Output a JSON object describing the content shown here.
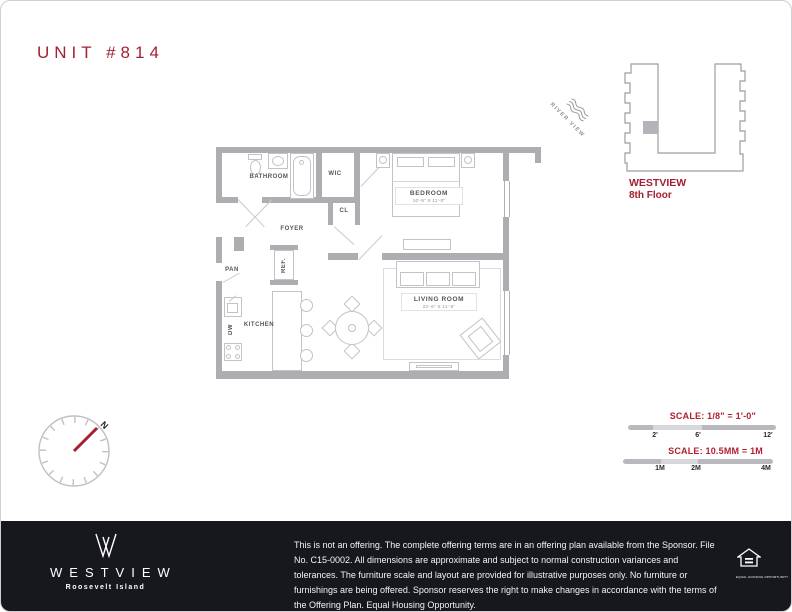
{
  "page": {
    "title": "UNIT #814"
  },
  "plan": {
    "labels": {
      "bathroom": "BATHROOM",
      "wic": "WIC",
      "closet": "CL",
      "foyer": "FOYER",
      "bedroom": "BEDROOM",
      "bedroom_dims": "10'-9\" X 11'-0\"",
      "pantry": "PAN",
      "refrigerator": "REF.",
      "kitchen": "KITCHEN",
      "dishwasher": "DW",
      "living_room": "LIVING ROOM",
      "living_room_dims": "22'-6\" X 11'-6\"",
      "river_view": "RIVER VIEW"
    }
  },
  "key_plan": {
    "building_name": "WESTVIEW",
    "floor": "8th Floor"
  },
  "compass": {
    "north": "N"
  },
  "scales": {
    "imperial": {
      "title": "SCALE: 1/8\" = 1'-0\"",
      "ticks": [
        "2'",
        "6'",
        "12'"
      ]
    },
    "metric": {
      "title": "SCALE: 10.5MM = 1M",
      "ticks": [
        "1M",
        "2M",
        "4M"
      ]
    }
  },
  "footer": {
    "brand": "WESTVIEW",
    "location": "Roosevelt Island",
    "disclaimer": "This is not an offering. The complete offering terms are in an offering plan available from the Sponsor. File No. C15-0002. All dimensions are approximate and subject to normal construction variances and tolerances. The furniture scale and layout are provided for illustrative purposes only. No furniture or furnishings are being offered. Sponsor reserves the right to make changes in accordance with the terms of the Offering Plan. Equal Housing Opportunity.",
    "equal_housing_label": "EQUAL HOUSING OPPORTUNITY"
  },
  "colors": {
    "brand_red": "#a31f31",
    "wall_gray": "#aeaeb2",
    "footer_bg": "#17171e"
  }
}
